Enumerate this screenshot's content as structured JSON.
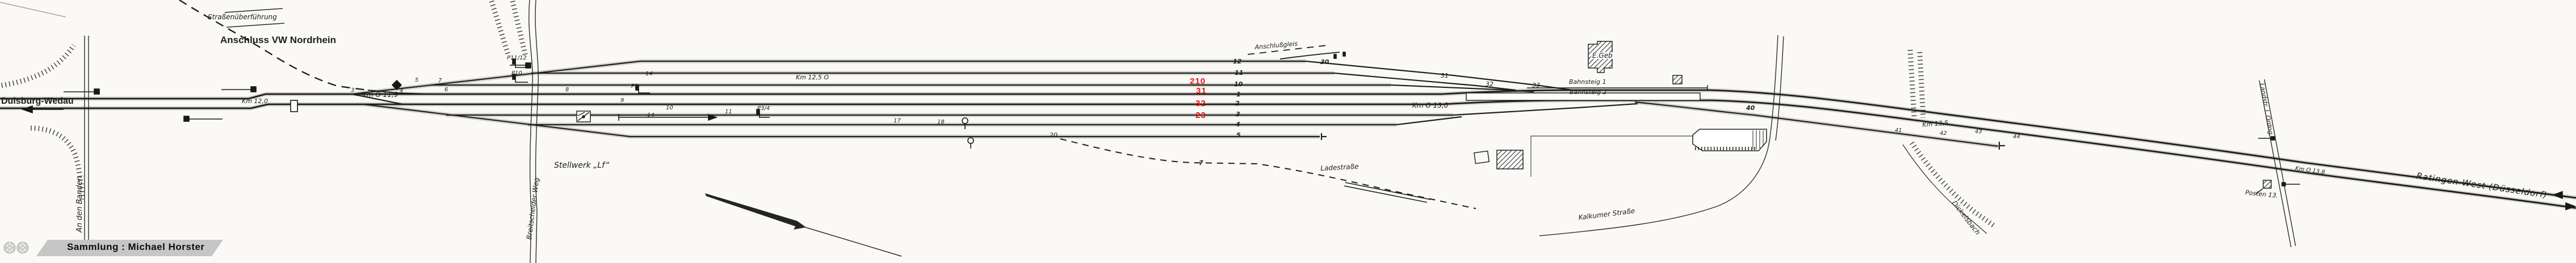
{
  "diagram": {
    "bridge_label": "Straßenüberführung",
    "vw_connection": "Anschluss VW Nordrhein",
    "station_left": "Duisburg-Wedau",
    "station_right": "Ratingen-West (Düsseldorf)",
    "signal_box": "Stellwerk „Lf“",
    "station_building": "E.Geb",
    "platform_1": "Bahnsteig 1",
    "platform_2": "Bahnsteig 2",
    "crossing_post": "Posten 13.",
    "siding_label": "Anschlußgleis"
  },
  "streets": {
    "an_den_banden": "An den Banden",
    "breitscheider_weg": "Breitscheider Weg",
    "ladestrasse": "Ladestraße",
    "kalkumer_strasse": "Kalkumer Straße",
    "dickelsbach": "Dickelsbach",
    "landstrasse": "Landstr. I. Ordng."
  },
  "km_posts": {
    "km119": "Km O 11,9",
    "km120": "Km 12,0",
    "km125": "Km 12,5 O",
    "km130": "Km O 13,0",
    "km135": "Km 13,5",
    "km138": "Km O 13,8"
  },
  "red_track_numbers": {
    "n210": "210",
    "n31": "31",
    "n32": "32",
    "n23": "23"
  },
  "track_numbers": {
    "t12": "12",
    "t11": "11",
    "t10": "10",
    "t1": "1",
    "t2": "2",
    "t3": "3",
    "t4": "4",
    "t5": "5",
    "t7": "7",
    "t30": "30",
    "t40": "40"
  },
  "switch_numbers": {
    "s3": "3",
    "s4": "4",
    "s5": "5",
    "s6": "6",
    "s7": "7",
    "s8": "8",
    "s9": "9",
    "s10": "10",
    "s11": "11",
    "s14a": "14",
    "s14b": "14",
    "s17": "17",
    "s18": "18",
    "s20": "20",
    "s31": "31",
    "s32": "32",
    "s33": "33",
    "s41": "41",
    "s42": "42",
    "s43": "43",
    "s44": "44"
  },
  "signals": {
    "p11_12": "P11/12",
    "p10": "P10",
    "p1": "P1",
    "p3_4": "P3/4"
  },
  "footer": {
    "collection": "Sammlung : Michael Horster"
  },
  "colors": {
    "highlight_red": "#ee1410",
    "ink": "#202020",
    "paper": "#faf9f6",
    "banner_gray": "#c6c6c6"
  }
}
